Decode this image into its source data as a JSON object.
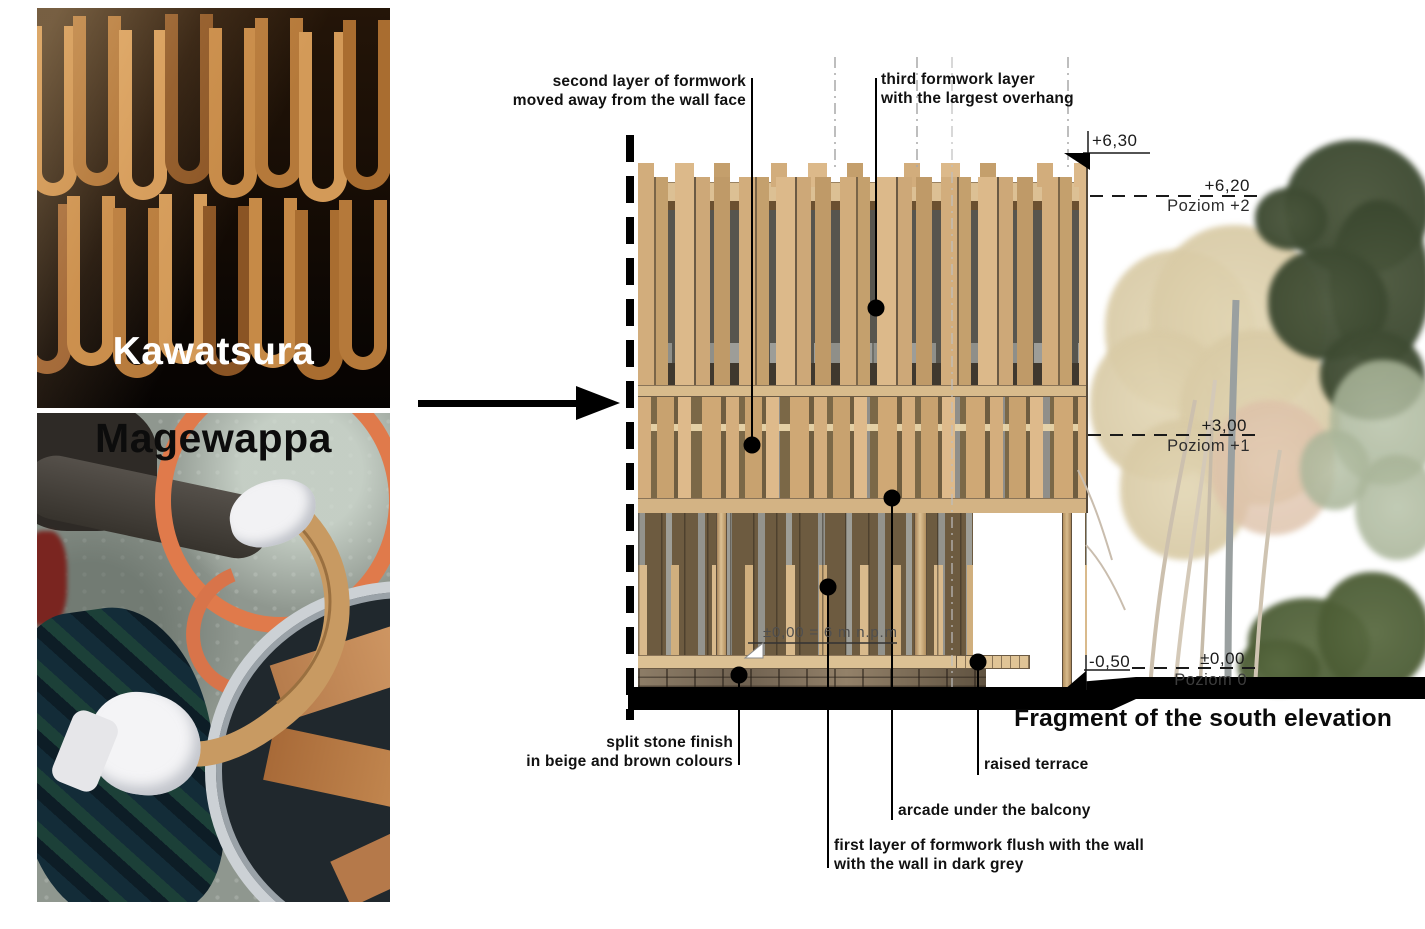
{
  "title": "Fragment of the south elevation",
  "photos": {
    "kawatsura": {
      "caption": "Kawatsura"
    },
    "magewappa": {
      "caption": "Magewappa"
    }
  },
  "callouts": {
    "second_layer": {
      "line1": "second layer of formwork",
      "line2": "moved away from the wall face"
    },
    "third_layer": {
      "line1": "third formwork layer",
      "line2": "with the largest overhang"
    },
    "split_stone": {
      "line1": "split stone finish",
      "line2": "in beige and brown colours"
    },
    "first_layer": {
      "line1": "first layer of formwork flush with the wall",
      "line2": "with the wall in dark grey"
    },
    "arcade": {
      "label": "arcade under the balcony"
    },
    "raised_terrace": {
      "label": "raised terrace"
    }
  },
  "levels": {
    "roof": {
      "value": "+6,30"
    },
    "level2": {
      "value": "+6,20",
      "name": "Poziom +2"
    },
    "level1": {
      "value": "+3,00",
      "name": "Poziom +1"
    },
    "level0": {
      "value": "±0,00",
      "name": "Poziom 0"
    },
    "below_ground": {
      "value": "-0,50"
    },
    "datum_note": "±0,00 = 6 m n.p.m"
  },
  "colors": {
    "wood_light": "#dcb98a",
    "wood_mid": "#c4a06d",
    "wood_dark": "#8a6f4c",
    "wall_dark_grey": "#57554e",
    "wall_brown": "#6d5b40",
    "stone_beige": "#8d7d67",
    "stone_brown": "#5f5240",
    "ground_black": "#000000",
    "tree_green": "#41503a",
    "tree_autumn": "#ddd0ae",
    "annotation_black": "#111111"
  }
}
